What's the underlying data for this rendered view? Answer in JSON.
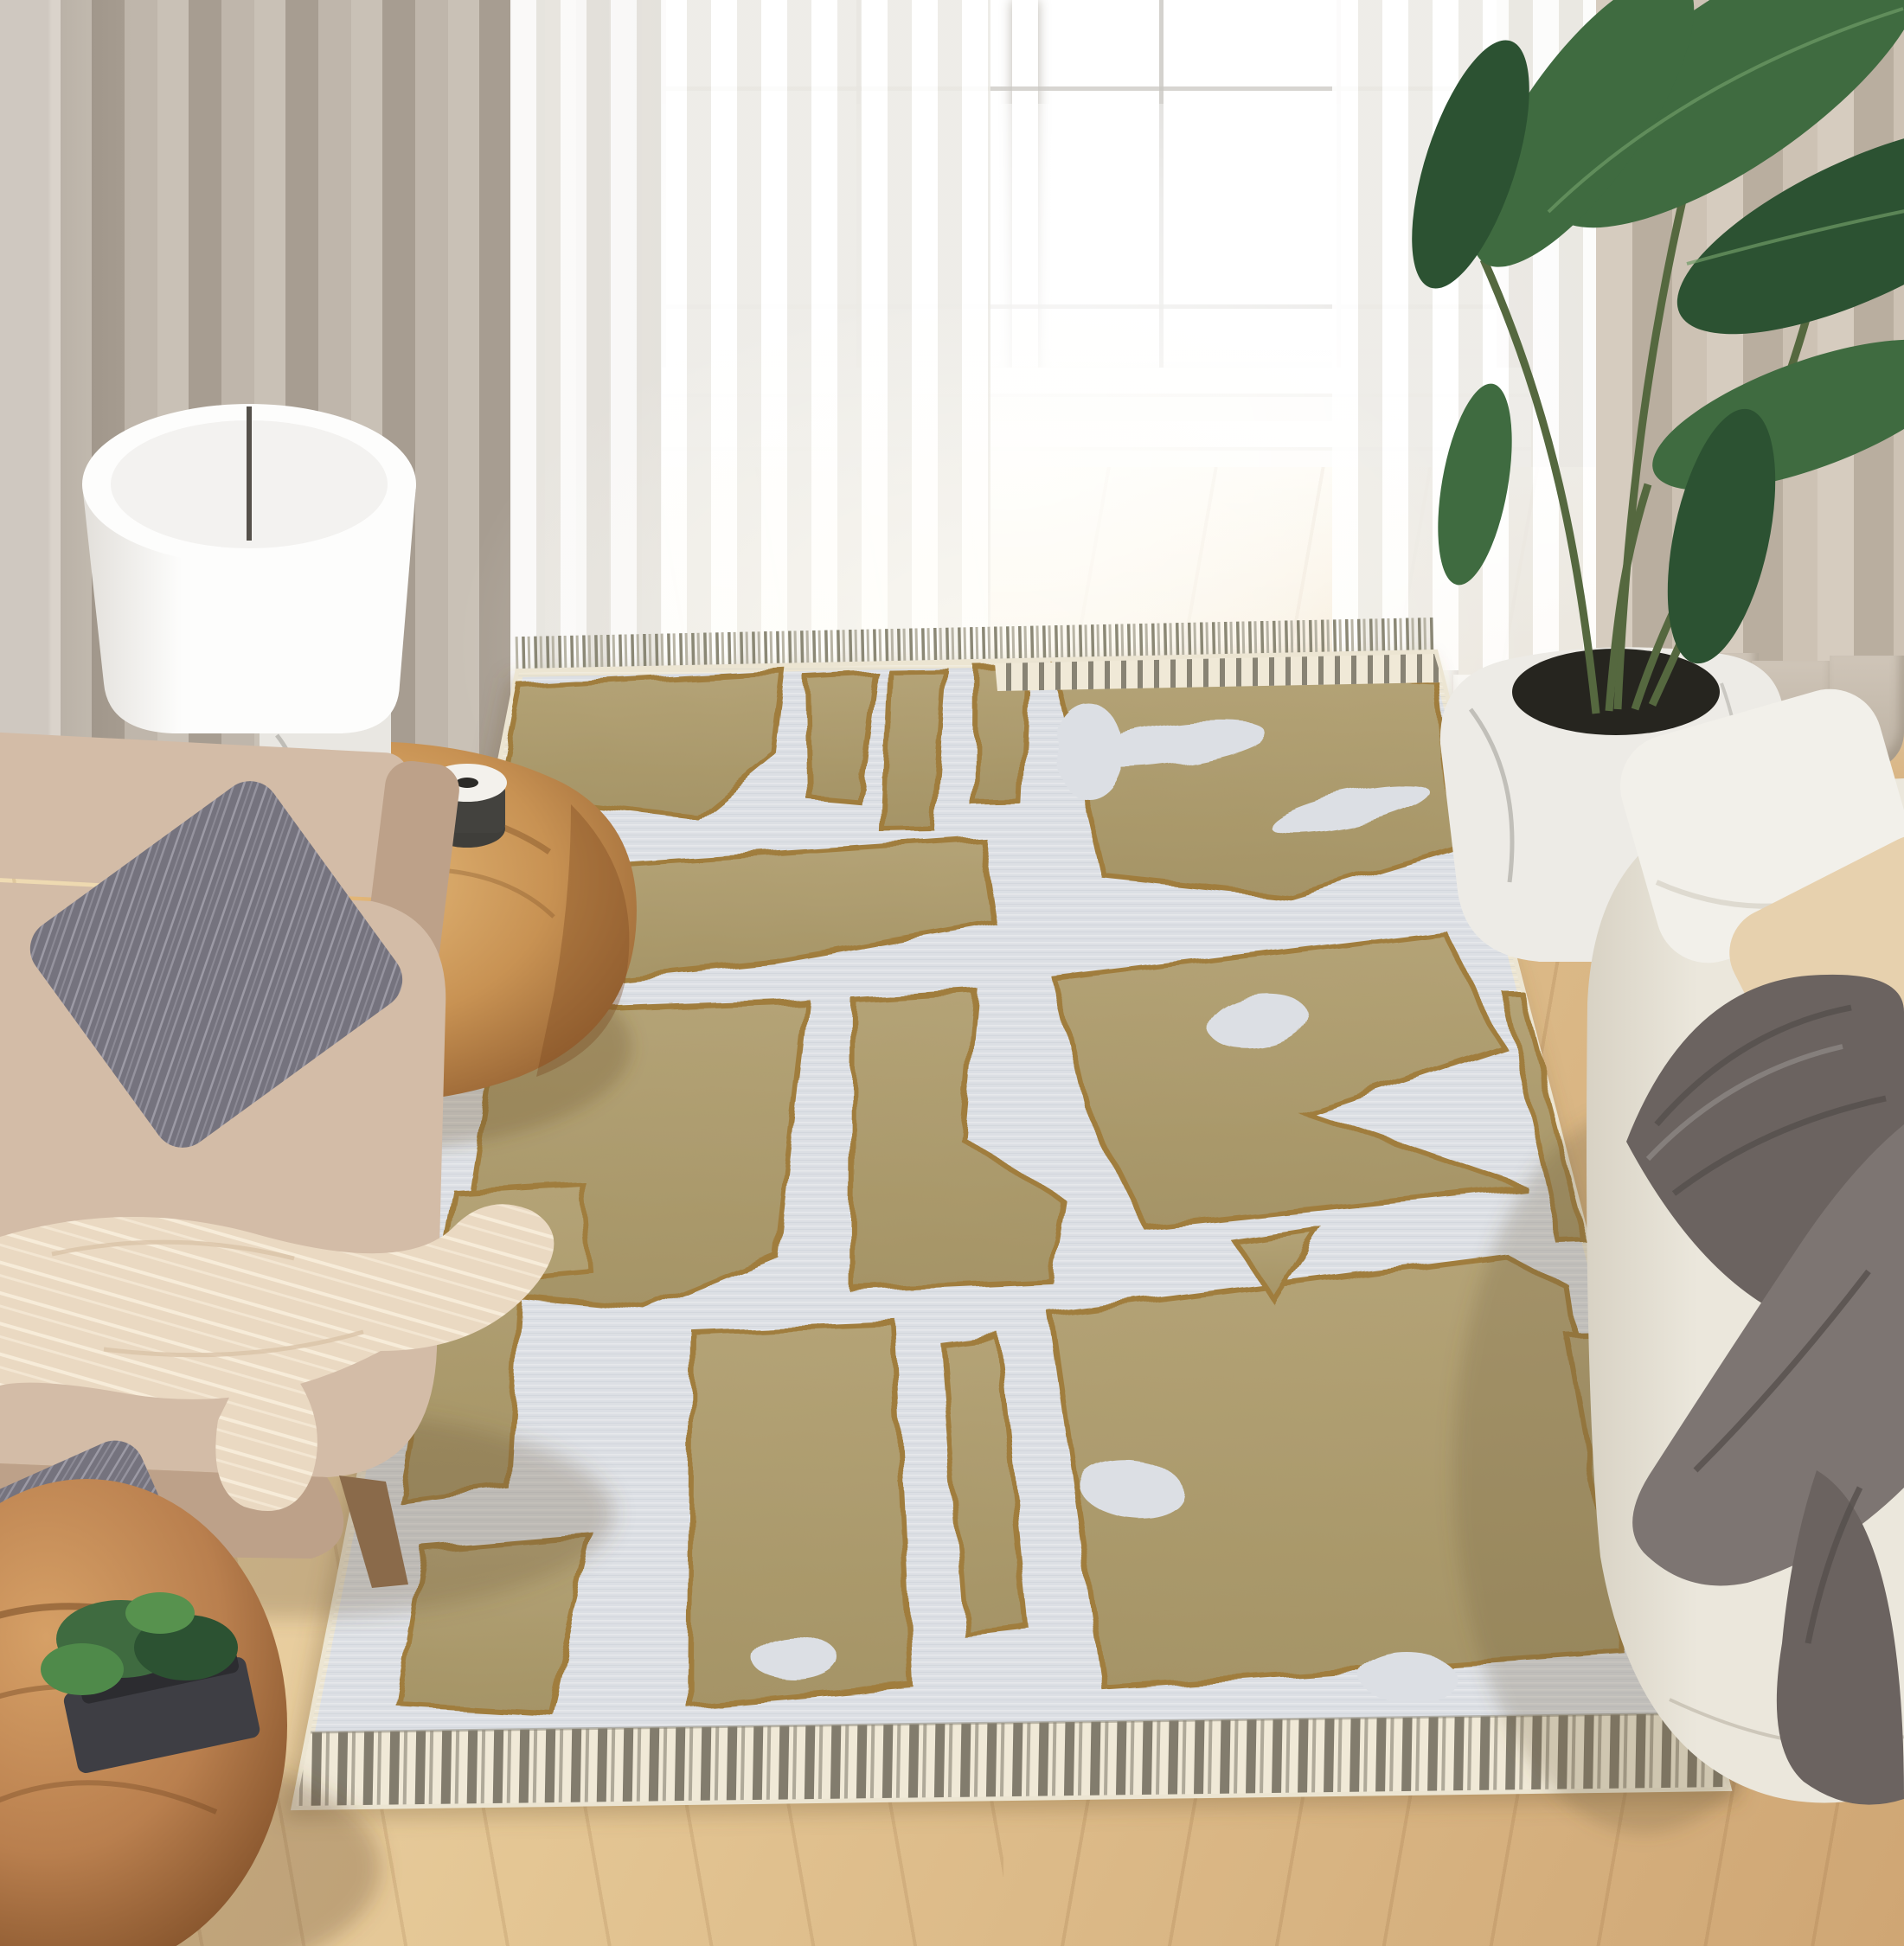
{
  "scene": {
    "title": "Sunlit living room with a cream and tan abstract tufted area rug",
    "type": "interior lifestyle photograph",
    "room": "living room",
    "description": "Top-down angled view of a living room: bright paned window with sheer white curtains and a taupe drape, light wood plank floor, large flat-woven rug with raised tan abstract shapes, striped end borders and fringe, beige armchair with gray striped pillows and a cream throw, wooden stump side table with a white drum lamp, round wood stool with a small plant, and a cream sofa with a dark gray throw blanket beside a tall potted bird-of-paradise plant.",
    "objects": [
      {
        "label": "bright paned window"
      },
      {
        "label": "white sheer curtains"
      },
      {
        "label": "taupe curtain panel"
      },
      {
        "label": "beige curtain panel"
      },
      {
        "label": "light wood plank floor"
      },
      {
        "label": "cream and tan abstract tufted area rug with striped border and fringe"
      },
      {
        "label": "white drum table lamp with marble base"
      },
      {
        "label": "live-edge wood stump side table"
      },
      {
        "label": "beige upholstered armchair"
      },
      {
        "label": "gray striped throw pillows"
      },
      {
        "label": "cream striped throw blanket"
      },
      {
        "label": "round carved wood stool"
      },
      {
        "label": "small green plant on dark tray"
      },
      {
        "label": "cream fabric sofa"
      },
      {
        "label": "white and beige sofa pillows"
      },
      {
        "label": "dark gray draped throw blanket"
      },
      {
        "label": "white marble planter"
      },
      {
        "label": "bird of paradise plant"
      }
    ]
  },
  "palette": {
    "wall": "#dcd6cf",
    "curtain_taupe_light": "#c9c1b6",
    "curtain_taupe_dark": "#a79d91",
    "sheer_white": "#f8f7f4",
    "curtain_beige_light": "#d6ccbf",
    "curtain_beige_dark": "#b9ae9f",
    "window_white": "#ffffff",
    "mullion_gray": "#c9c7c2",
    "floor_light": "#f1dfb9",
    "floor_mid": "#e4c694",
    "floor_dark": "#cfa674",
    "plank_line": "#93683c",
    "rug_ground": "#dcdfe4",
    "rug_cream_edge": "#ece5d2",
    "rug_tan": "#b4a376",
    "rug_tan_deep": "#a59466",
    "rug_outline": "#a07d3e",
    "band_cream": "#f0e9d7",
    "band_stripe": "#6e695b",
    "fringe_dark": "#85826f",
    "fringe_light": "#b5b1a2",
    "chair_beige": "#d3bca7",
    "chair_beige_deep": "#bda189",
    "pillow_gray": "#75737e",
    "pillow_gray_stripe": "#a3a1ac",
    "blanket_cream": "#ead9c2",
    "blanket_cream_hi": "#f7ecd9",
    "stump_wood": "#c89253",
    "stump_wood_deep": "#8f5c2e",
    "stool_wood": "#b97f4e",
    "stool_wood_deep": "#7a4a24",
    "tray_dark": "#3e3e44",
    "plant_green": "#3f6b40",
    "plant_green_deep": "#2c5232",
    "plant_stem": "#55683f",
    "sofa_cream": "#ebe7dc",
    "sofa_cream_deep": "#d8d2c4",
    "pillow_white": "#f2f0ea",
    "pillow_tan": "#e7d1ae",
    "throw_gray": "#6b6360",
    "throw_gray_deep": "#544e4b",
    "throw_gray_hi": "#7d7572",
    "planter_white": "#edebe6",
    "planter_opening": "#26251f",
    "marble_vein": "#95938b",
    "lamp_white": "#fdfdfc",
    "lamp_shadow": "#e2dfda",
    "lamp_slit": "#55514b"
  }
}
